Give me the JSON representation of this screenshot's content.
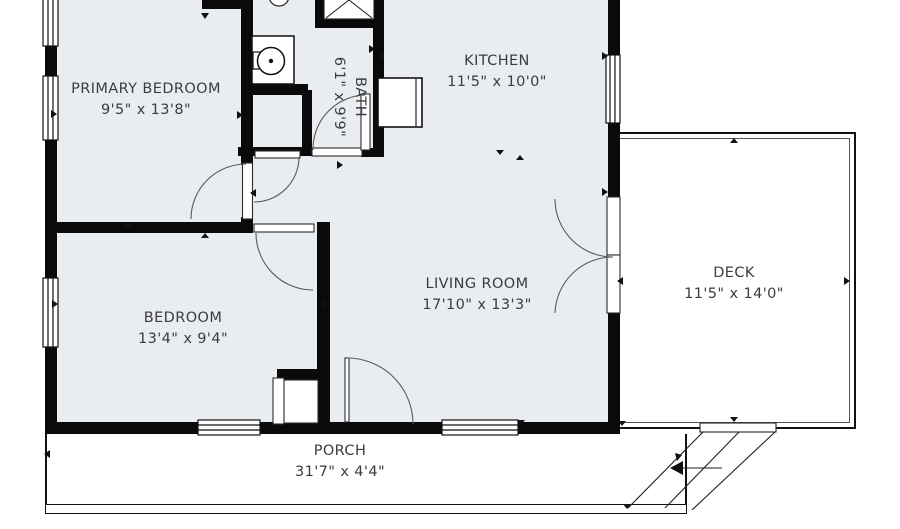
{
  "meta": {
    "view": "2D floor plan",
    "floor_color": "#E9EDF1",
    "wall_color": "#0A0A0A",
    "outline_color": "#222222",
    "arc_color": "#5A5A5A",
    "text_color": "#3C3C3C"
  },
  "rooms": {
    "primary_bedroom": {
      "name": "PRIMARY BEDROOM",
      "dims": "9'5\" x 13'8\""
    },
    "bath": {
      "name": "BATH",
      "dims": "6'1\" x 9'9\""
    },
    "kitchen": {
      "name": "KITCHEN",
      "dims": "11'5\" x 10'0\""
    },
    "living_room": {
      "name": "LIVING ROOM",
      "dims": "17'10\" x 13'3\""
    },
    "bedroom": {
      "name": "BEDROOM",
      "dims": "13'4\" x 9'4\""
    },
    "deck": {
      "name": "DECK",
      "dims": "11'5\" x 14'0\""
    },
    "porch": {
      "name": "PORCH",
      "dims": "31'7\" x 4'4\""
    }
  },
  "fixtures": {
    "toilet": "toilet-icon",
    "sink": "sink-icon",
    "shower": "shower-icon",
    "appliance": "refrigerator-icon",
    "stairs": "deck-stairs-arrow"
  }
}
